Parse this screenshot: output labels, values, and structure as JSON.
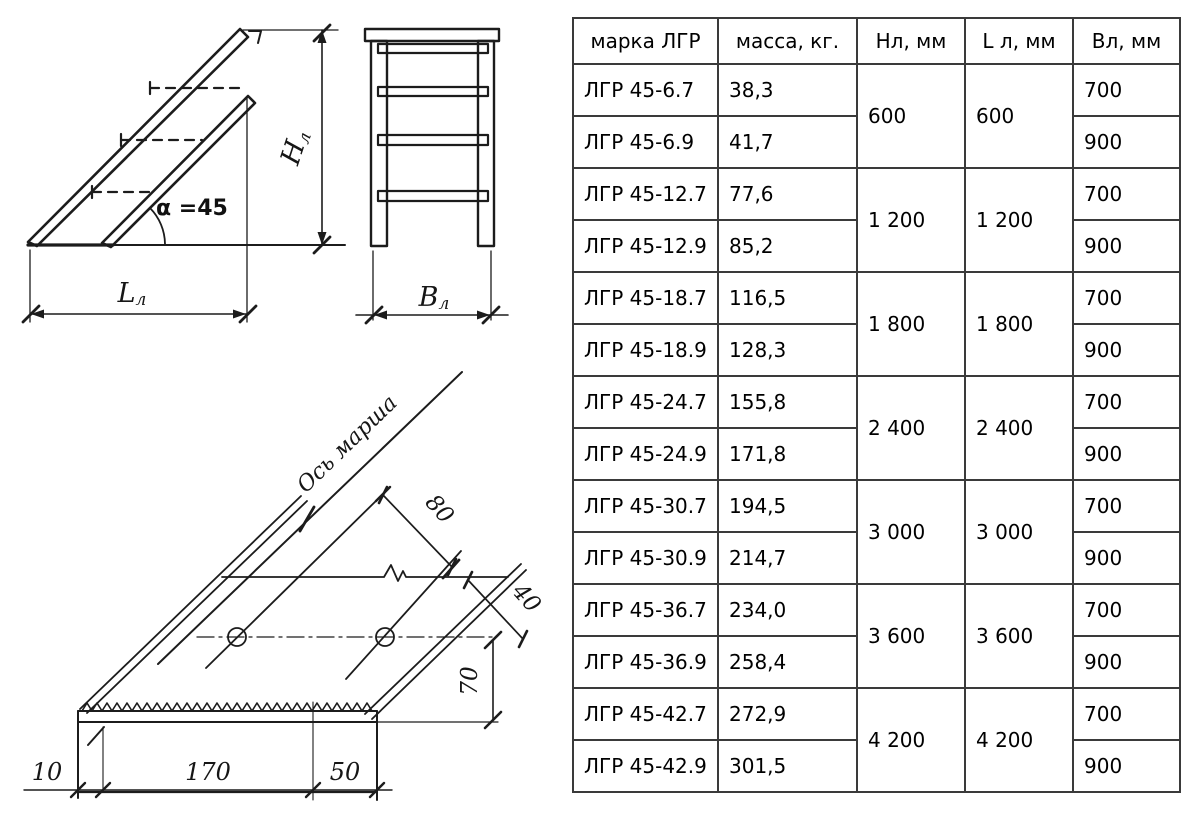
{
  "colors": {
    "ink": "#1c1c1c",
    "table_border": "#3a3a3a",
    "background": "#ffffff"
  },
  "drawings": {
    "side_view": {
      "angle_label": "α =45",
      "height_label": {
        "main": "Н",
        "sub": "л"
      },
      "length_label": {
        "main": "L",
        "sub": "л"
      }
    },
    "front_view": {
      "width_label": {
        "main": "В",
        "sub": "л"
      }
    },
    "tread_detail": {
      "axis_label": "Ось марша",
      "dims": {
        "d80": "80",
        "d40": "40",
        "d70": "70",
        "d10": "10",
        "d170": "170",
        "d50": "50"
      }
    }
  },
  "table": {
    "headers": [
      "марка ЛГР",
      "масса, кг.",
      "Нл, мм",
      "L л, мм",
      "Вл, мм"
    ],
    "groups": [
      {
        "h_mm": "600",
        "l_mm": "600",
        "rows": [
          {
            "mark": "ЛГР 45-6.7",
            "mass": "38,3",
            "v_mm": "700"
          },
          {
            "mark": "ЛГР 45-6.9",
            "mass": "41,7",
            "v_mm": "900"
          }
        ]
      },
      {
        "h_mm": "1 200",
        "l_mm": "1 200",
        "rows": [
          {
            "mark": "ЛГР 45-12.7",
            "mass": "77,6",
            "v_mm": "700"
          },
          {
            "mark": "ЛГР 45-12.9",
            "mass": "85,2",
            "v_mm": "900"
          }
        ]
      },
      {
        "h_mm": "1 800",
        "l_mm": "1 800",
        "rows": [
          {
            "mark": "ЛГР 45-18.7",
            "mass": "116,5",
            "v_mm": "700"
          },
          {
            "mark": "ЛГР 45-18.9",
            "mass": "128,3",
            "v_mm": "900"
          }
        ]
      },
      {
        "h_mm": "2 400",
        "l_mm": "2 400",
        "rows": [
          {
            "mark": "ЛГР 45-24.7",
            "mass": "155,8",
            "v_mm": "700"
          },
          {
            "mark": "ЛГР 45-24.9",
            "mass": "171,8",
            "v_mm": "900"
          }
        ]
      },
      {
        "h_mm": "3 000",
        "l_mm": "3 000",
        "rows": [
          {
            "mark": "ЛГР 45-30.7",
            "mass": "194,5",
            "v_mm": "700"
          },
          {
            "mark": "ЛГР 45-30.9",
            "mass": "214,7",
            "v_mm": "900"
          }
        ]
      },
      {
        "h_mm": "3 600",
        "l_mm": "3 600",
        "rows": [
          {
            "mark": "ЛГР 45-36.7",
            "mass": "234,0",
            "v_mm": "700"
          },
          {
            "mark": "ЛГР 45-36.9",
            "mass": "258,4",
            "v_mm": "900"
          }
        ]
      },
      {
        "h_mm": "4 200",
        "l_mm": "4 200",
        "rows": [
          {
            "mark": "ЛГР 45-42.7",
            "mass": "272,9",
            "v_mm": "700"
          },
          {
            "mark": "ЛГР 45-42.9",
            "mass": "301,5",
            "v_mm": "900"
          }
        ]
      }
    ]
  }
}
